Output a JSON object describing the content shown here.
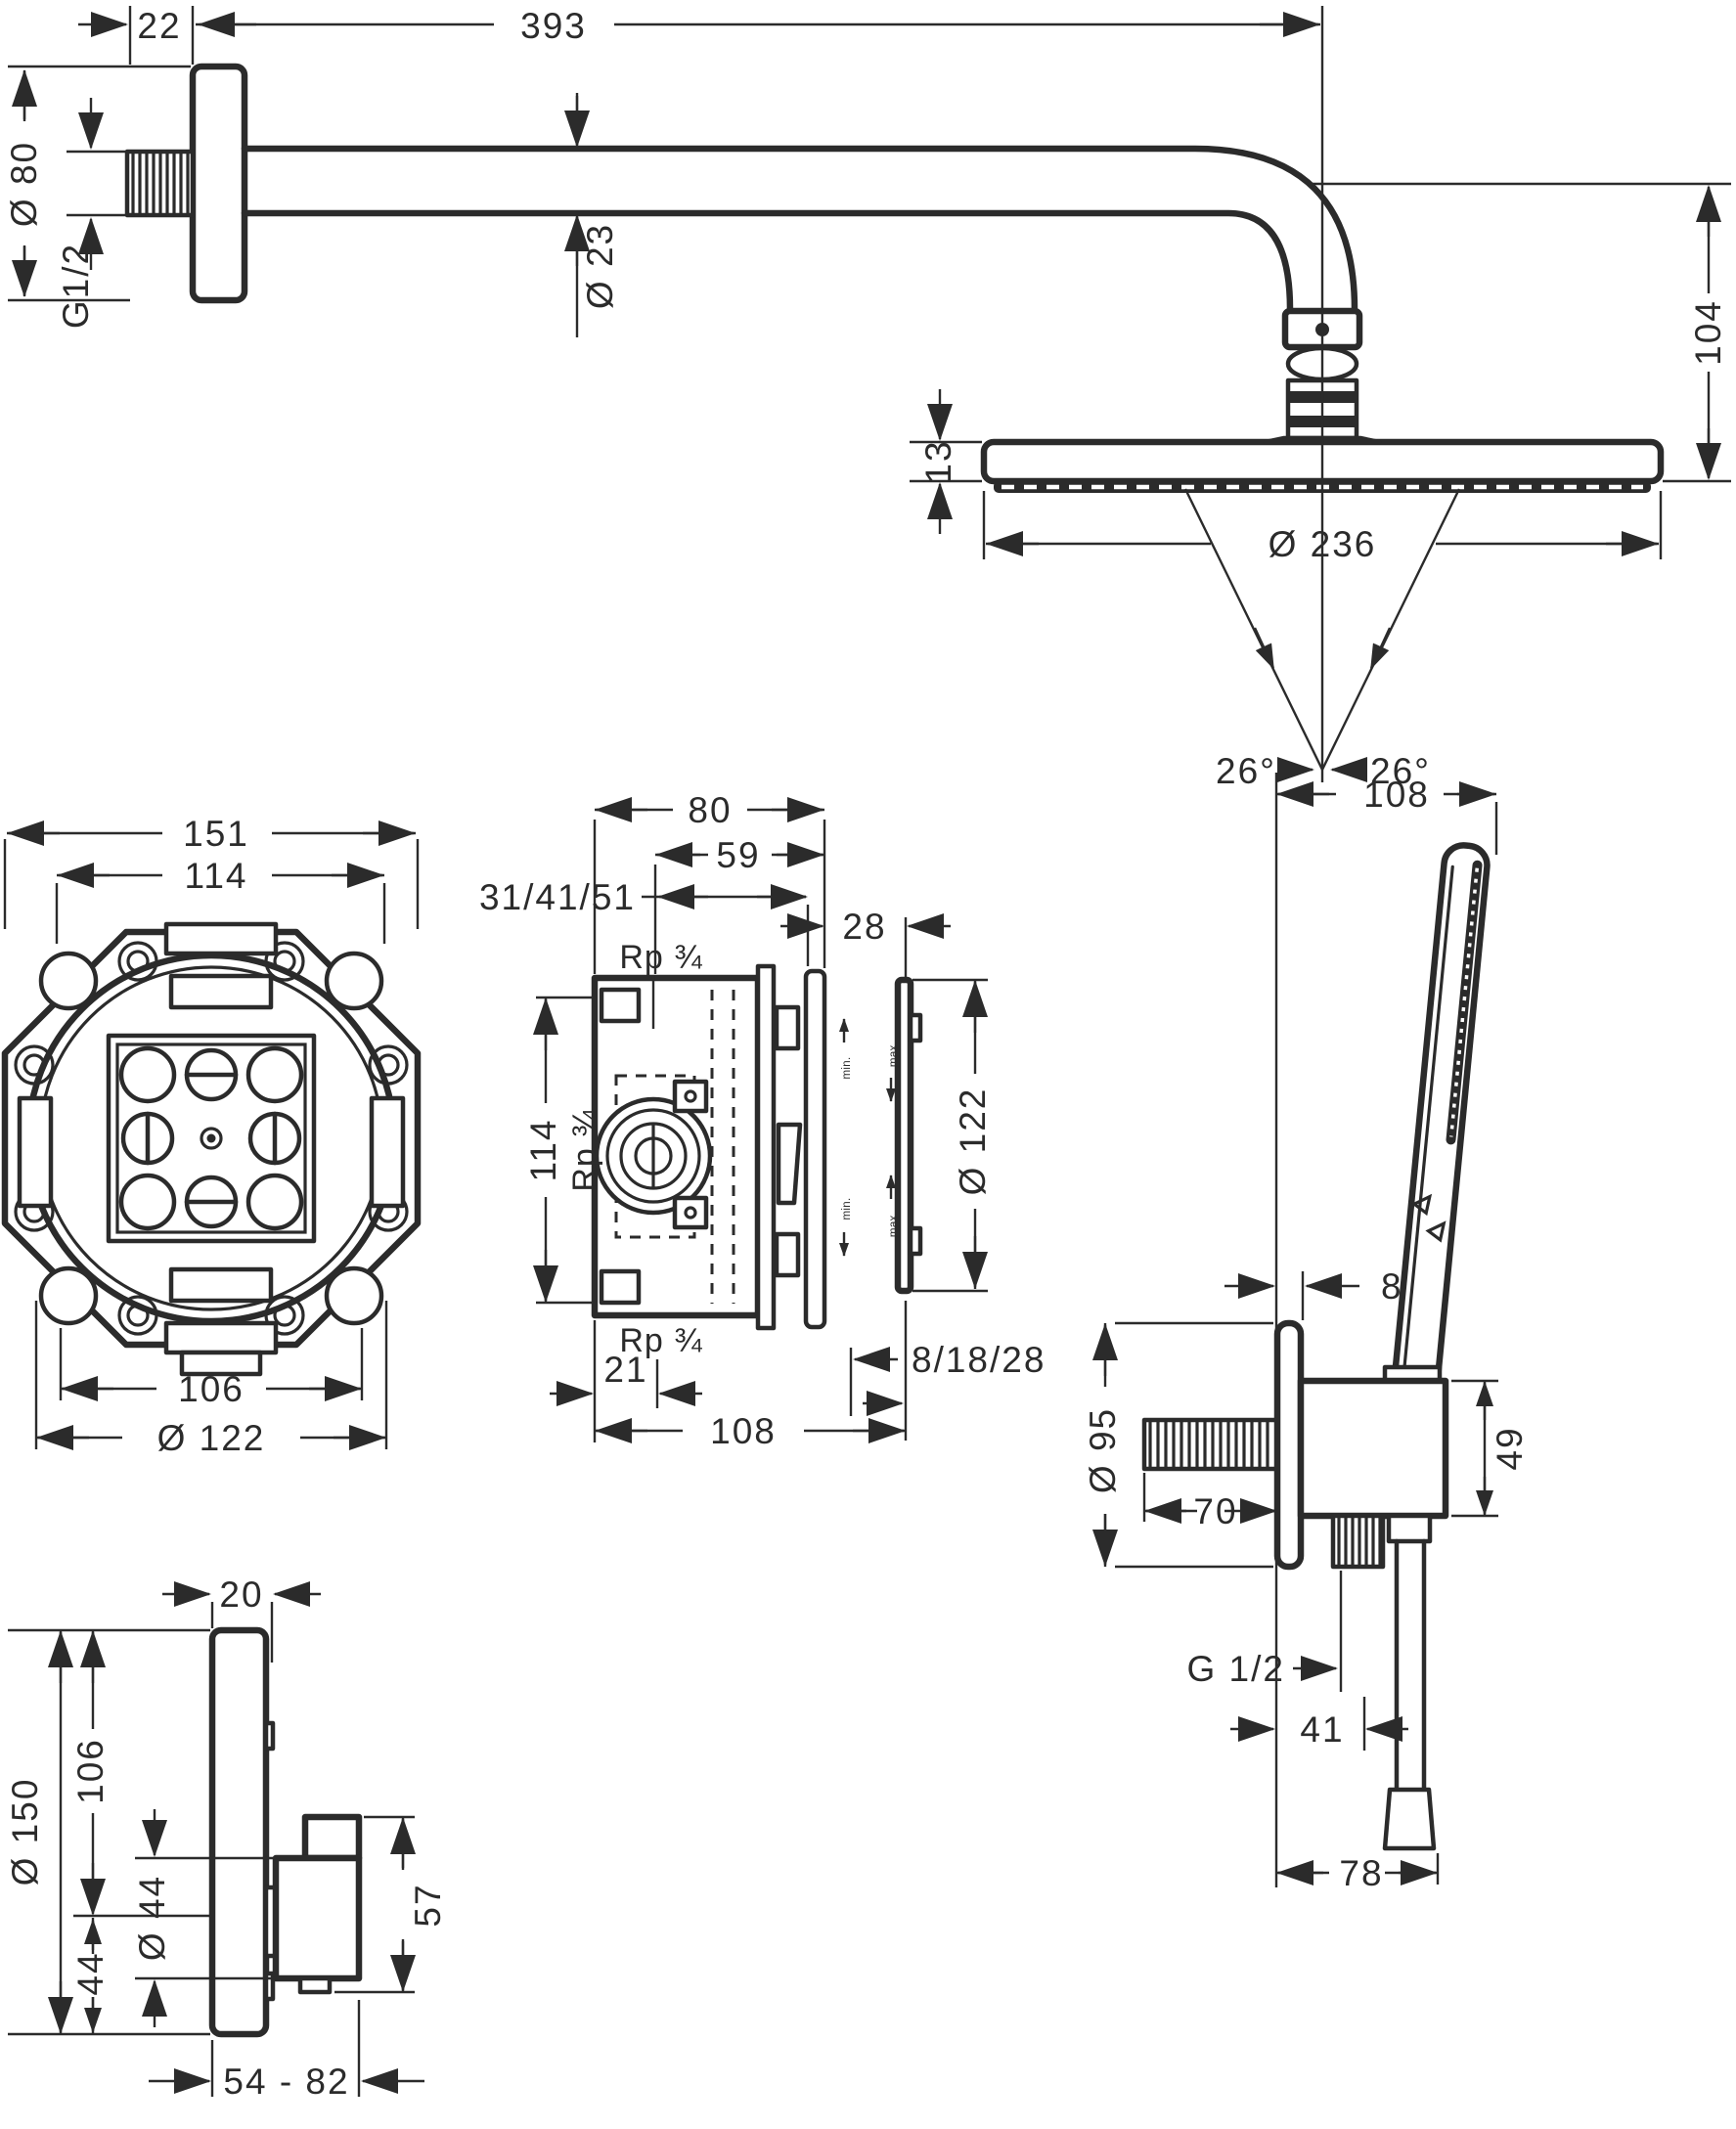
{
  "drawing": {
    "kind": "technical dimension drawing (mm)",
    "product": "concealed shower set: overhead shower with arm and ball joint, iBox basic set (front + section), hand shower with wall outlet and hose, concealed thermostat module",
    "views": {
      "overhead": {
        "wall_offset": "22",
        "arm_projection": "393",
        "flange_diameter": "Ø 80",
        "thread": "G1/2",
        "arm_diameter": "Ø 23",
        "drop_height": "104",
        "head_thickness": "13",
        "head_diameter": "Ø 236",
        "spray_angle_left": "26°",
        "spray_angle_right": "26°"
      },
      "ibox_front": {
        "flange_width": "151",
        "bolt_span": "114",
        "body_width": "106",
        "body_diameter": "Ø 122"
      },
      "ibox_section": {
        "depth_total": "80",
        "depth_front": "59",
        "depth_options": "31/41/51",
        "cover_depth": "28",
        "thread_top": "Rp ¾",
        "port_span": "114",
        "thread_mid": "Rp ¾",
        "cover_diameter": "Ø 122",
        "thread_bottom": "Rp ¾",
        "offset_bottom": "21",
        "width_total": "108",
        "trim_options": "8/18/28",
        "adjust_min_upper": "min.",
        "adjust_max_upper": "max.",
        "adjust_min_lower": "min.",
        "adjust_max_lower": "max."
      },
      "hand_shower": {
        "projection": "108",
        "plate_offset": "8",
        "plate_diameter": "Ø 95",
        "nipple_length": "70",
        "outlet_height": "49",
        "thread": "G 1/2",
        "hose_offset": "41",
        "hose_projection": "78"
      },
      "thermostat": {
        "plate_thickness": "20",
        "plate_diameter": "Ø 150",
        "handle_offset": "106",
        "handle_bottom": "44",
        "handle_diameter": "Ø 44",
        "handle_height": "57",
        "depth_range": "54 - 82"
      }
    }
  }
}
